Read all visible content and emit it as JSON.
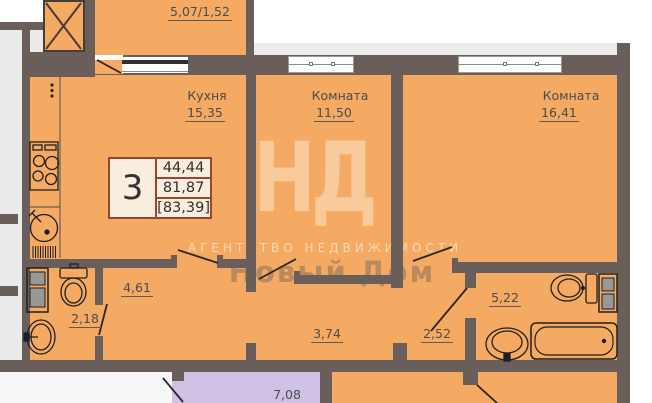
{
  "colors": {
    "floor": "#f4aa62",
    "wall": "#6a5e5b",
    "outside": "#ebebeb",
    "strip": "#ececea",
    "neighbor": "#cfc2e4",
    "infoborder": "#9c4433",
    "infobg": "#f9eedd",
    "text": "#4c4c4c"
  },
  "watermark": {
    "monogram": "НД",
    "agency": "АГЕНТСТВО НЕДВИЖИМОСТИ",
    "brand": "Новый Дом"
  },
  "info_box": {
    "room_count": "3",
    "living_area": "44,44",
    "apartment_area": "81,87",
    "total_area": "[83,39]"
  },
  "rooms": [
    {
      "kind": "balcony",
      "name": "",
      "area": "5,07/1,52"
    },
    {
      "kind": "kitchen",
      "name": "Кухня",
      "area": "15,35"
    },
    {
      "kind": "room",
      "name": "Комната",
      "area": "11,50"
    },
    {
      "kind": "room",
      "name": "Комната",
      "area": "16,41"
    },
    {
      "kind": "hall",
      "name": "",
      "area": "4,61"
    },
    {
      "kind": "wc",
      "name": "",
      "area": "2,18"
    },
    {
      "kind": "corridor",
      "name": "",
      "area": "3,74"
    },
    {
      "kind": "corridor",
      "name": "",
      "area": "2,52"
    },
    {
      "kind": "bathroom",
      "name": "",
      "area": "5,22"
    },
    {
      "kind": "entrance-lobby",
      "name": "",
      "area": "7,08"
    }
  ]
}
